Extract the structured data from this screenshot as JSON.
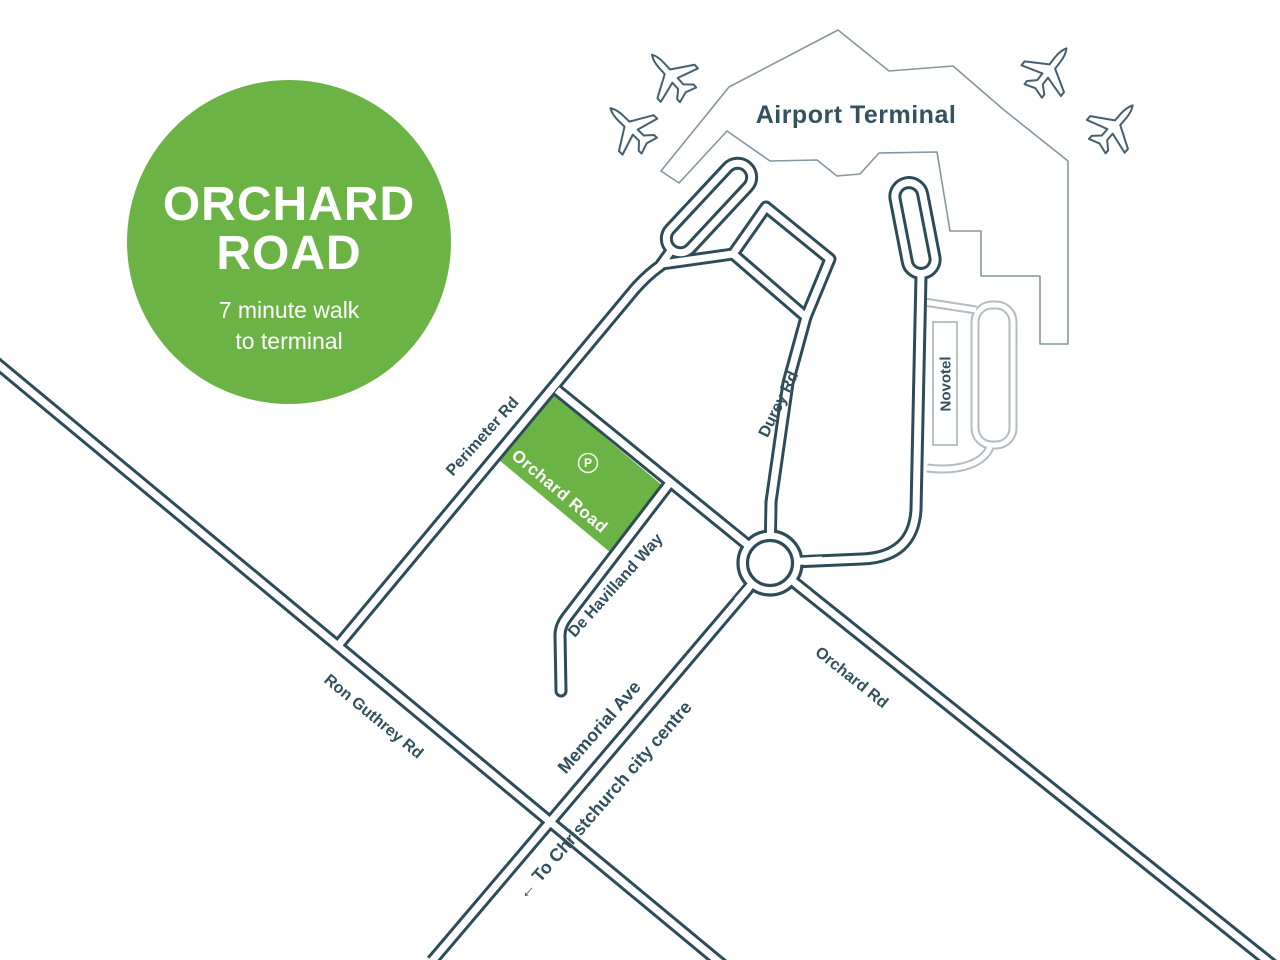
{
  "badge": {
    "title_line1": "ORCHARD",
    "title_line2": "ROAD",
    "subtitle_line1": "7 minute walk",
    "subtitle_line2": "to terminal"
  },
  "terminal": {
    "label": "Airport Terminal",
    "novotel_label": "Novotel"
  },
  "parking": {
    "label": "Orchard Road",
    "symbol": "P"
  },
  "roads": {
    "perimeter_rd": "Perimeter Rd",
    "durey_rd": "Durey Rd",
    "de_havilland_way": "De Havilland Way",
    "memorial_ave": "Memorial Ave",
    "ron_guthrey_rd": "Ron Guthrey Rd",
    "orchard_rd": "Orchard Rd",
    "city_centre": "← To Christchurch city centre"
  },
  "colors": {
    "green": "#6cb345",
    "slate": "#2e4b58",
    "terminal_outline": "#8496a1",
    "gray_road": "#b2bcc2",
    "background": "#ffffff"
  }
}
